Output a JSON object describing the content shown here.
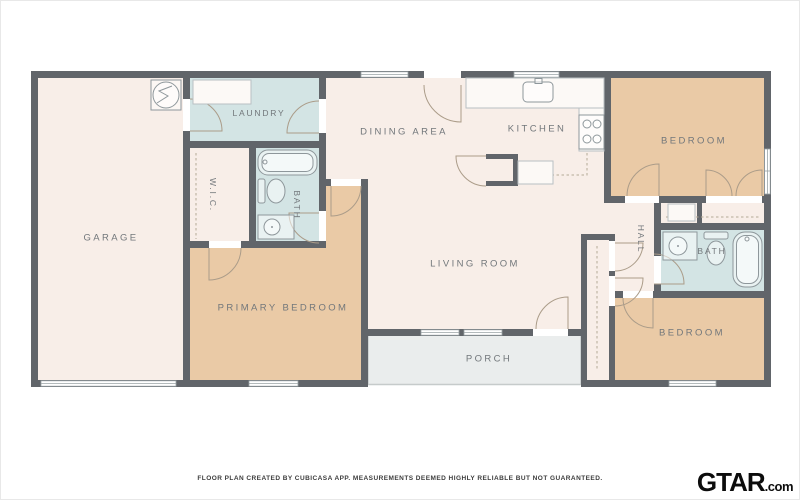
{
  "rooms": {
    "garage": {
      "label": "GARAGE"
    },
    "laundry": {
      "label": "LAUNDRY"
    },
    "wic": {
      "label": "W.I.C."
    },
    "bath_primary": {
      "label": "BATH"
    },
    "dining": {
      "label": "DINING AREA"
    },
    "kitchen": {
      "label": "KITCHEN"
    },
    "living": {
      "label": "LIVING ROOM"
    },
    "primary_bedroom": {
      "label": "PRIMARY BEDROOM"
    },
    "bedroom_top_right": {
      "label": "BEDROOM"
    },
    "hall": {
      "label": "HALL"
    },
    "bath_hall": {
      "label": "BATH"
    },
    "bedroom_bottom_right": {
      "label": "BEDROOM"
    },
    "porch": {
      "label": "PORCH"
    }
  },
  "footer": {
    "disclaimer": "FLOOR PLAN CREATED BY CUBICASA APP. MEASUREMENTS DEEMED HIGHLY RELIABLE BUT NOT GUARANTEED."
  },
  "logo": {
    "brand": "GTAR",
    "suffix": ".com"
  },
  "colors": {
    "wall": "#61656a",
    "floor": "#f8eee8",
    "bedroom": "#eacaa6",
    "wet_room": "#d3e4e4",
    "porch": "#eaeded",
    "door_arc": "#ab9c89",
    "closet_dash": "#b5a996"
  }
}
